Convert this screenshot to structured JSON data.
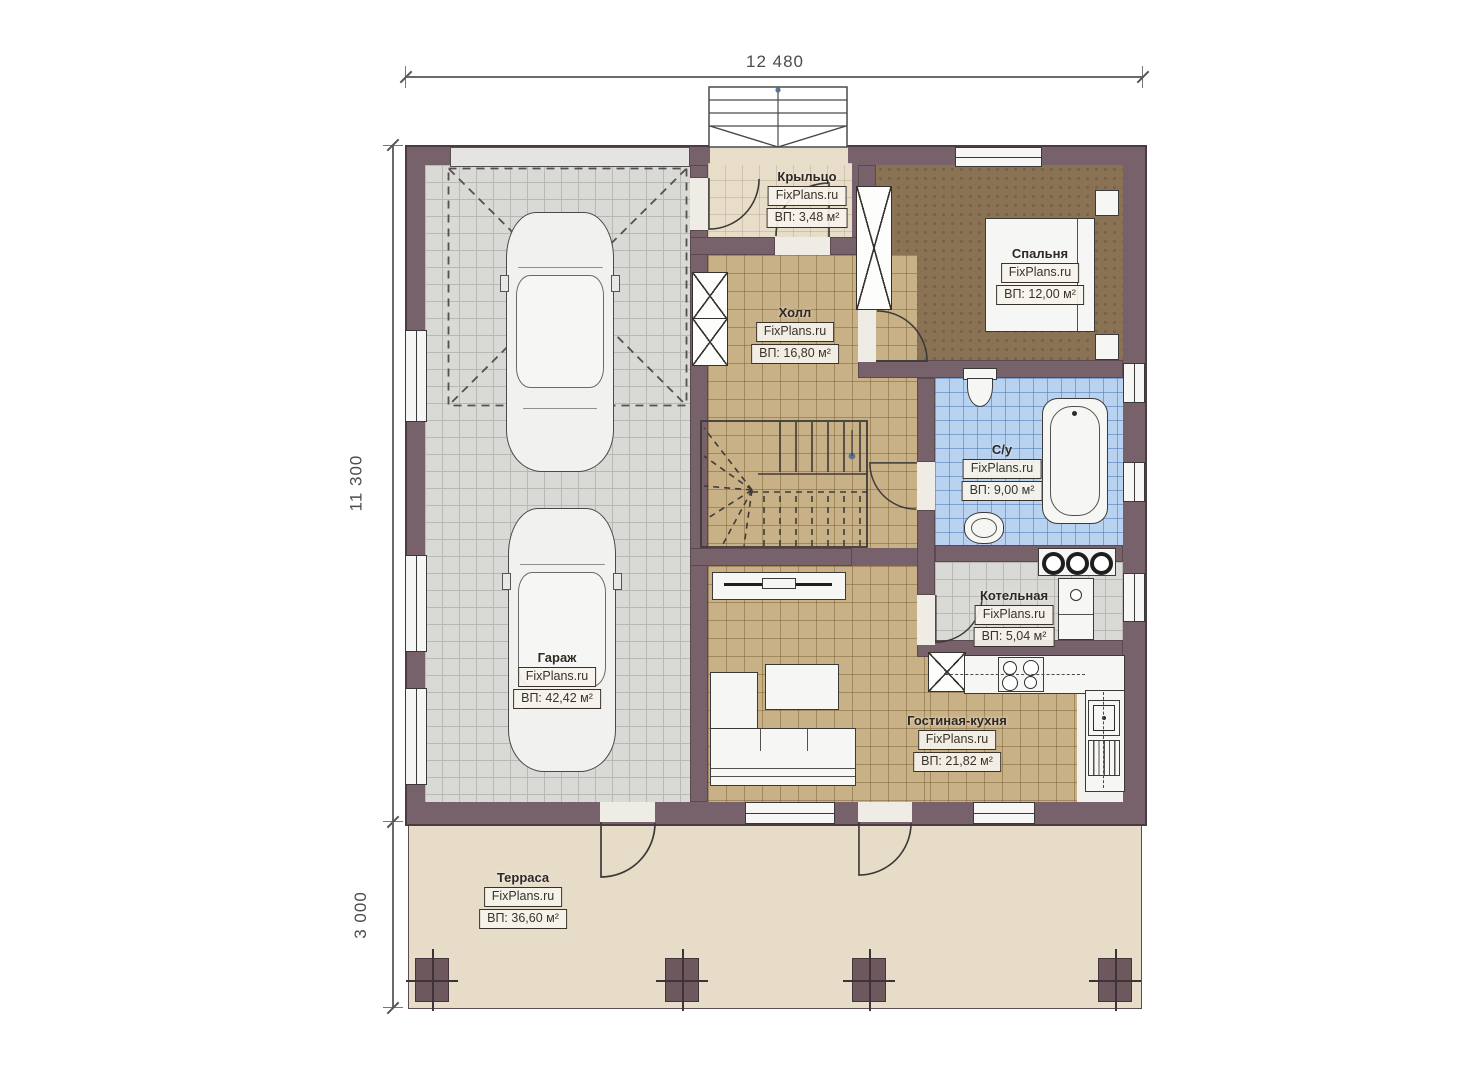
{
  "watermark": "FixPlans.ru",
  "dimensions": {
    "width_top": "12 480",
    "height_main": "11 300",
    "height_terrace": "3 000"
  },
  "rooms": {
    "porch": {
      "name": "Крыльцо",
      "area": "ВП: 3,48 м²"
    },
    "hall": {
      "name": "Холл",
      "area": "ВП: 16,80 м²"
    },
    "bedroom": {
      "name": "Спальня",
      "area": "ВП: 12,00 м²"
    },
    "bathroom": {
      "name": "С/у",
      "area": "ВП: 9,00 м²"
    },
    "boiler": {
      "name": "Котельная",
      "area": "ВП: 5,04 м²"
    },
    "garage": {
      "name": "Гараж",
      "area": "ВП: 42,42 м²"
    },
    "living": {
      "name": "Гостиная-кухня",
      "area": "ВП: 21,82 м²"
    },
    "terrace": {
      "name": "Терраса",
      "area": "ВП: 36,60 м²"
    }
  },
  "colors": {
    "wall": "#77626b",
    "garage_floor": "#d9d9d6",
    "hall_floor": "#c9b187",
    "bedroom_floor": "#8a7254",
    "bathroom_floor": "#b8d2f0",
    "porch_floor": "#e8ddc9",
    "terrace_floor": "#e6dcc8",
    "line": "#3c3a38"
  }
}
